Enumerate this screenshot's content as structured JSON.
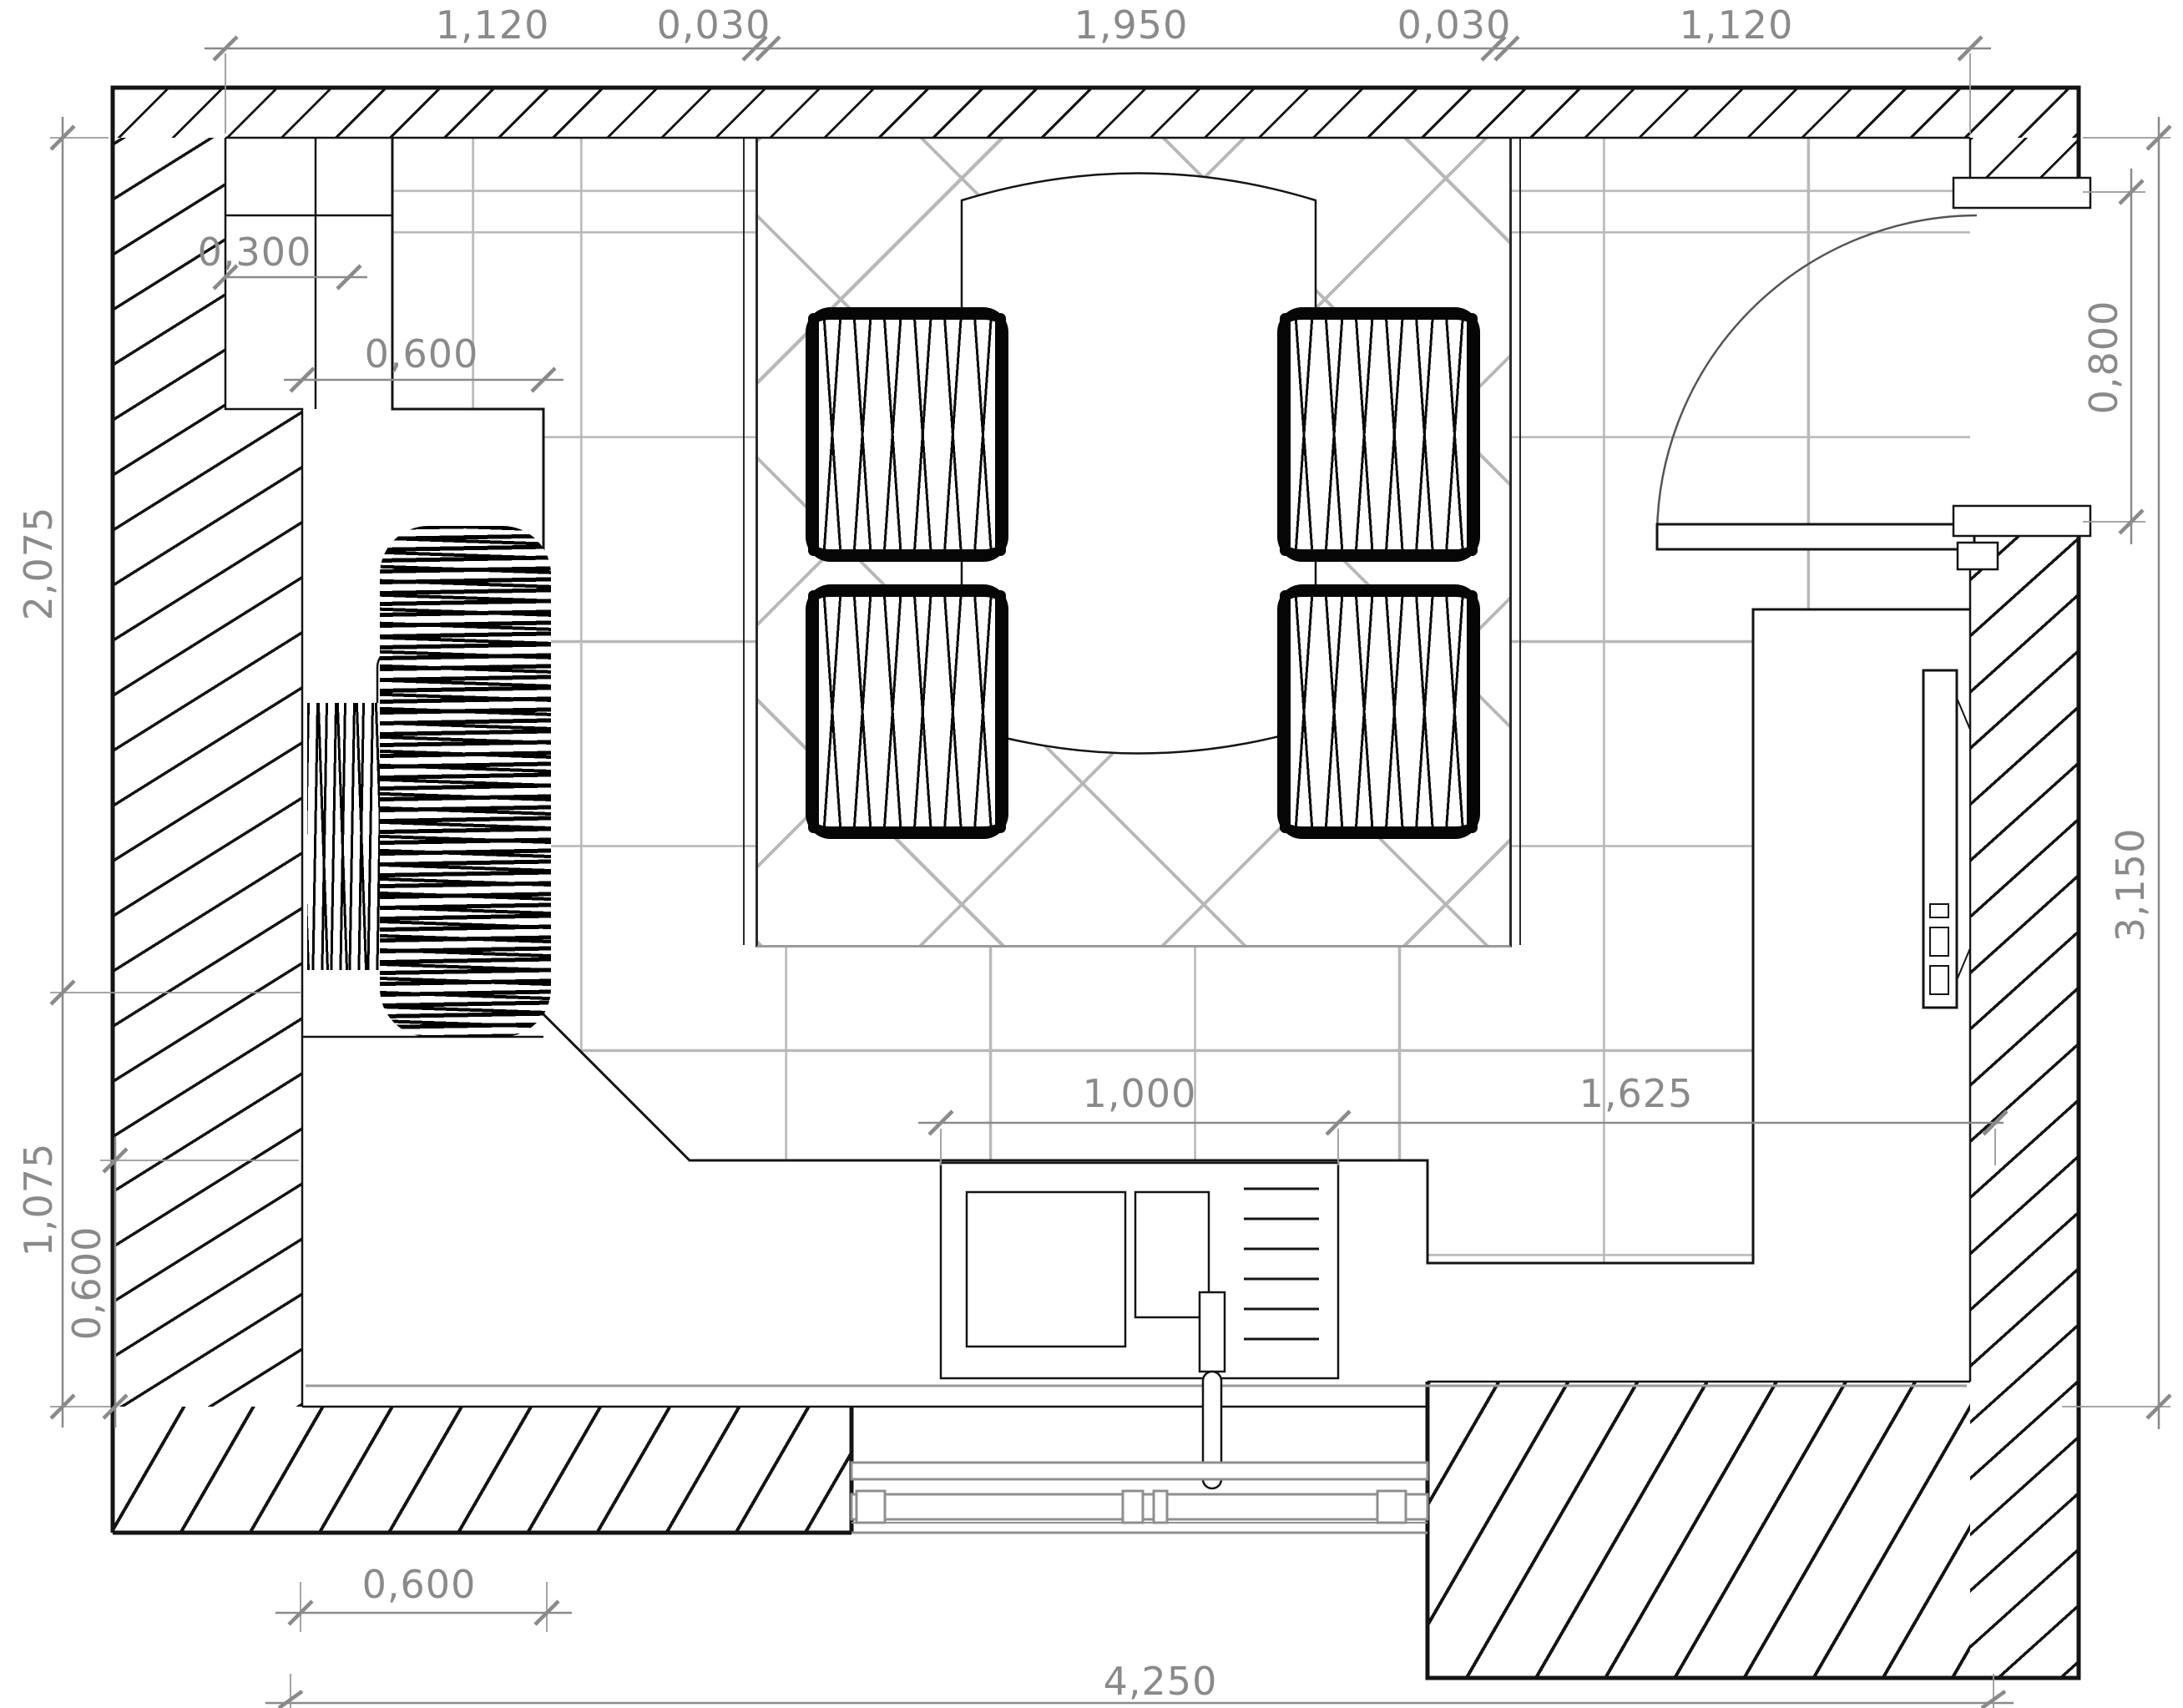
{
  "colors": {
    "line": "#141414",
    "dimension": "#8a8a8a",
    "tile_grid": "#b8b8b8",
    "background": "#ffffff"
  },
  "dimensions": {
    "top": [
      "1,120",
      "0,030",
      "1,950",
      "0,030",
      "1,120"
    ],
    "left_outer": [
      "2,075",
      "1,075"
    ],
    "left_inner": [
      "0,600"
    ],
    "cabinets": [
      "0,300",
      "0,600"
    ],
    "right_door": [
      "0,800"
    ],
    "right_room": [
      "3,150"
    ],
    "counter_run": [
      "1,000",
      "1,625"
    ],
    "bottom_outer": [
      "0,600",
      "4,250"
    ]
  }
}
